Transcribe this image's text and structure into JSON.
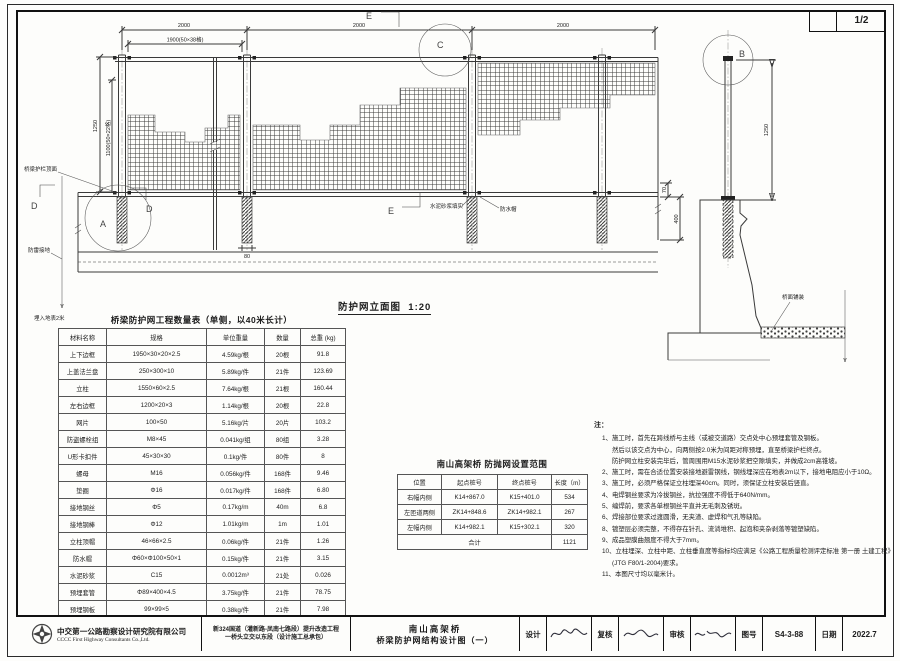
{
  "page": {
    "number": "1/2"
  },
  "elevation": {
    "title": "防护网立面图",
    "scale": "1:20",
    "dims": {
      "bay1": "2000",
      "bay2": "2000",
      "bay3": "2000",
      "mesh_width": "1900(50×38格)",
      "post_height": "1250",
      "mesh_height": "1100(50×22格)",
      "base_width": "80",
      "offset_70": "70",
      "embed_400": "400"
    },
    "labels": {
      "guardrail_top": "桥梁护栏顶面",
      "lightning_ground": "防雷接地",
      "buried": "埋入地表2米",
      "mortar_fill": "水泥砂浆填实",
      "water_cap": "防水帽"
    },
    "marks": {
      "a": "A",
      "b": "B",
      "c": "C",
      "d": "D",
      "e": "E"
    }
  },
  "side_view": {
    "dim_height": "1250",
    "deck_label": "桥面铺装"
  },
  "quantity_table": {
    "title": "桥梁防护网工程数量表（单侧，以40米长计）",
    "headers": [
      "材料名称",
      "规格",
      "单位重量",
      "数量",
      "总重 (kg)"
    ],
    "rows": [
      [
        "上下边框",
        "1950×30×20×2.5",
        "4.59kg/根",
        "20根",
        "91.8"
      ],
      [
        "上盖法兰盘",
        "250×300×10",
        "5.89kg/件",
        "21件",
        "123.69"
      ],
      [
        "立柱",
        "1550×60×2.5",
        "7.64kg/根",
        "21根",
        "160.44"
      ],
      [
        "左右边框",
        "1200×20×3",
        "1.14kg/根",
        "20根",
        "22.8"
      ],
      [
        "网片",
        "100×50",
        "5.16kg/片",
        "20片",
        "103.2"
      ],
      [
        "防盗螺栓组",
        "M8×45",
        "0.041kg/组",
        "80组",
        "3.28"
      ],
      [
        "U形卡扣件",
        "45×30×30",
        "0.1kg/件",
        "80件",
        "8"
      ],
      [
        "螺母",
        "M16",
        "0.056kg/件",
        "168件",
        "9.46"
      ],
      [
        "垫圈",
        "Φ16",
        "0.017kg/件",
        "168件",
        "6.80"
      ],
      [
        "接地钢丝",
        "Φ5",
        "0.17kg/m",
        "40m",
        "6.8"
      ],
      [
        "接地钢棒",
        "Φ12",
        "1.01kg/m",
        "1m",
        "1.01"
      ],
      [
        "立柱顶帽",
        "46×66×2.5",
        "0.06kg/件",
        "21件",
        "1.26"
      ],
      [
        "防水帽",
        "Φ60×Φ100×50×1",
        "0.15kg/件",
        "21件",
        "3.15"
      ],
      [
        "水泥砂浆",
        "C15",
        "0.0012m³",
        "21处",
        "0.026"
      ],
      [
        "预埋套管",
        "Φ89×400×4.5",
        "3.75kg/件",
        "21件",
        "78.75"
      ],
      [
        "预埋钢板",
        "99×99×5",
        "0.38kg/件",
        "21件",
        "7.98"
      ]
    ]
  },
  "range_table": {
    "title": "南山高架桥 防抛网设置范围",
    "headers": [
      "位置",
      "起点桩号",
      "终点桩号",
      "长度（m）"
    ],
    "rows": [
      [
        "右幅内侧",
        "K14+867.0",
        "K15+401.0",
        "534"
      ],
      [
        "左匝道两侧",
        "ZK14+848.6",
        "ZK14+982.1",
        "267"
      ],
      [
        "左幅内侧",
        "K14+982.1",
        "K15+302.1",
        "320"
      ]
    ],
    "total_label": "合计",
    "total_value": "1121"
  },
  "notes": {
    "heading": "注：",
    "items": [
      {
        "t": "1、施工时，首先在跨线桥与主线（或被交道路）交点处中心预埋套管及钢板。"
      },
      {
        "t": "然后以该交点为中心，向两侧按2.0米为间距对称预埋，直至桥梁护栏终点。",
        "c": true
      },
      {
        "t": "防护网立柱安装完毕后，管周围用M15水泥砂浆把空隙填实，并做成2cm高锥坡。",
        "c": true
      },
      {
        "t": "2、施工时，需在合适位置安装接地避雷钢线，钢线埋深应在地表2m以下，接地电阻应小于10Ω。"
      },
      {
        "t": "3、施工时，必须严格保证立柱埋深40cm。同时，须保证立柱安装后竖直。"
      },
      {
        "t": "4、电焊钢丝要求为冷拔钢丝，抗拉强度不得低于640N/mm。"
      },
      {
        "t": "5、编焊前，要求各单根钢丝平直并无毛刺及锈斑。"
      },
      {
        "t": "6、焊接部位要求过渡圆滑，无夹渣、虚焊和气孔等缺陷。"
      },
      {
        "t": "8、镀塑层必须完整，不得存在针孔、流淌堆积、起泡和夹杂剥落等镀塑缺陷。"
      },
      {
        "t": "9、成品塑膜曲翘度不得大于7mm。"
      },
      {
        "t": "10、立柱埋深、立柱中距、立柱垂直度等指标均应满足《公路工程质量检测评定标准 第一册 土建工程》"
      },
      {
        "t": "(JTG F80/1-2004)要求。",
        "c": true
      },
      {
        "t": "11、本图尺寸均以毫米计。"
      }
    ]
  },
  "title_block": {
    "company_cn": "中交第一公路勘察设计研究院有限公司",
    "company_en": "CCCC First Highway Consultants Co.,Ltd.",
    "project_line1": "新324国道（灌新路-凤南七路段）提升改造工程",
    "project_line2": "一桥头立交以东段（设计施工总承包）",
    "drawing_line1": "南山高架桥",
    "drawing_line2": "桥梁防护网结构设计图（一）",
    "design_label": "设计",
    "check_label": "复核",
    "review_label": "审核",
    "sheet_label": "图号",
    "sheet_no": "S4-3-88",
    "date_label": "日期",
    "date_value": "2022.7"
  }
}
